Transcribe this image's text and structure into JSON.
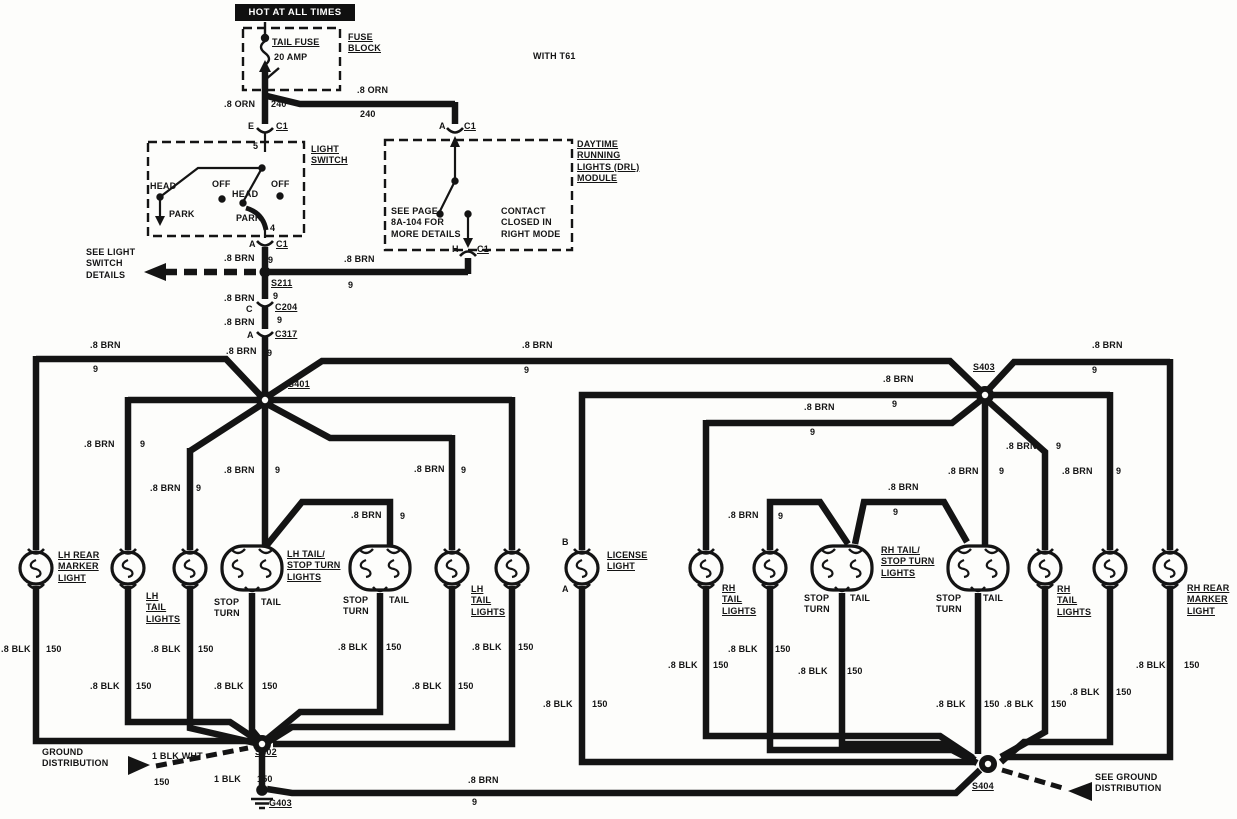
{
  "meta": {
    "title": "Tail lamp / daytime running lights wiring diagram",
    "ink": "#141414",
    "paper": "#fdfdfb"
  },
  "banner": {
    "text": "HOT AT ALL TIMES"
  },
  "labels": [
    {
      "n": "fuse-name-label",
      "t": "TAIL FUSE",
      "x": 272,
      "y": 37,
      "u": 1
    },
    {
      "n": "fuse-rating-label",
      "t": "20 AMP",
      "x": 274,
      "y": 52
    },
    {
      "n": "fuse-block-label",
      "t": "FUSE\nBLOCK",
      "x": 348,
      "y": 32,
      "u": 1
    },
    {
      "n": "option-note",
      "t": "WITH T61",
      "x": 533,
      "y": 51
    },
    {
      "n": "wire-label",
      "t": ".8 ORN",
      "x": 224,
      "y": 99
    },
    {
      "n": "circuit-label",
      "t": "240",
      "x": 271,
      "y": 99
    },
    {
      "n": "wire-label",
      "t": ".8 ORN",
      "x": 357,
      "y": 85
    },
    {
      "n": "circuit-label",
      "t": "240",
      "x": 360,
      "y": 109
    },
    {
      "n": "pin-label",
      "t": "E",
      "x": 248,
      "y": 121
    },
    {
      "n": "connector-label",
      "t": "C1",
      "x": 276,
      "y": 121,
      "u": 1
    },
    {
      "n": "pin-label",
      "t": "A",
      "x": 439,
      "y": 121
    },
    {
      "n": "connector-label",
      "t": "C1",
      "x": 464,
      "y": 121,
      "u": 1
    },
    {
      "n": "light-switch-label",
      "t": "LIGHT\nSWITCH",
      "x": 311,
      "y": 144,
      "u": 1
    },
    {
      "n": "pin-label",
      "t": "5",
      "x": 253,
      "y": 141
    },
    {
      "n": "switch-pos-label",
      "t": "HEAD",
      "x": 150,
      "y": 181
    },
    {
      "n": "switch-pos-label",
      "t": "OFF",
      "x": 212,
      "y": 179
    },
    {
      "n": "switch-pos-label",
      "t": "HEAD",
      "x": 232,
      "y": 189
    },
    {
      "n": "switch-pos-label",
      "t": "OFF",
      "x": 271,
      "y": 179
    },
    {
      "n": "switch-pos-label",
      "t": "PARK",
      "x": 169,
      "y": 209
    },
    {
      "n": "switch-pos-label",
      "t": "PARK",
      "x": 236,
      "y": 213
    },
    {
      "n": "pin-label",
      "t": "4",
      "x": 270,
      "y": 223
    },
    {
      "n": "pin-label",
      "t": "A",
      "x": 249,
      "y": 239
    },
    {
      "n": "connector-label",
      "t": "C1",
      "x": 276,
      "y": 239,
      "u": 1
    },
    {
      "n": "note-see-light-switch",
      "t": "SEE LIGHT\nSWITCH\nDETAILS",
      "x": 86,
      "y": 247
    },
    {
      "n": "wire-label",
      "t": ".8 BRN",
      "x": 224,
      "y": 253
    },
    {
      "n": "circuit-label",
      "t": "9",
      "x": 268,
      "y": 255
    },
    {
      "n": "splice-label",
      "t": "S211",
      "x": 271,
      "y": 278,
      "u": 1
    },
    {
      "n": "circuit-label",
      "t": "9",
      "x": 273,
      "y": 291
    },
    {
      "n": "wire-label",
      "t": ".8 BRN",
      "x": 344,
      "y": 254
    },
    {
      "n": "circuit-label",
      "t": "9",
      "x": 348,
      "y": 280
    },
    {
      "n": "drl-module-label",
      "t": "DAYTIME\nRUNNING\nLIGHTS (DRL)\nMODULE",
      "x": 577,
      "y": 139,
      "u": 1
    },
    {
      "n": "note-see-page",
      "t": "SEE PAGE\n8A-104 FOR\nMORE DETAILS",
      "x": 391,
      "y": 206
    },
    {
      "n": "note-contact",
      "t": "CONTACT\nCLOSED IN\nRIGHT MODE",
      "x": 501,
      "y": 206
    },
    {
      "n": "pin-label",
      "t": "H",
      "x": 452,
      "y": 244
    },
    {
      "n": "connector-label",
      "t": "C1",
      "x": 477,
      "y": 244,
      "u": 1
    },
    {
      "n": "wire-label",
      "t": ".8 BRN",
      "x": 224,
      "y": 293
    },
    {
      "n": "pin-label",
      "t": "C",
      "x": 246,
      "y": 304
    },
    {
      "n": "connector-label",
      "t": "C204",
      "x": 275,
      "y": 302,
      "u": 1
    },
    {
      "n": "circuit-label",
      "t": "9",
      "x": 277,
      "y": 315
    },
    {
      "n": "wire-label",
      "t": ".8 BRN",
      "x": 224,
      "y": 317
    },
    {
      "n": "pin-label",
      "t": "A",
      "x": 247,
      "y": 330
    },
    {
      "n": "connector-label",
      "t": "C317",
      "x": 275,
      "y": 329,
      "u": 1
    },
    {
      "n": "wire-label",
      "t": ".8 BRN",
      "x": 226,
      "y": 346
    },
    {
      "n": "circuit-label",
      "t": "9",
      "x": 267,
      "y": 348
    },
    {
      "n": "wire-label",
      "t": ".8 BRN",
      "x": 90,
      "y": 340
    },
    {
      "n": "circuit-label",
      "t": "9",
      "x": 93,
      "y": 364
    },
    {
      "n": "splice-label",
      "t": "S401",
      "x": 288,
      "y": 379,
      "u": 1
    },
    {
      "n": "wire-label",
      "t": ".8 BRN",
      "x": 84,
      "y": 439
    },
    {
      "n": "circuit-label",
      "t": "9",
      "x": 140,
      "y": 439
    },
    {
      "n": "wire-label",
      "t": ".8 BRN",
      "x": 150,
      "y": 483
    },
    {
      "n": "circuit-label",
      "t": "9",
      "x": 196,
      "y": 483
    },
    {
      "n": "wire-label",
      "t": ".8 BRN",
      "x": 224,
      "y": 465
    },
    {
      "n": "circuit-label",
      "t": "9",
      "x": 275,
      "y": 465
    },
    {
      "n": "wire-label",
      "t": ".8 BRN",
      "x": 414,
      "y": 464
    },
    {
      "n": "circuit-label",
      "t": "9",
      "x": 461,
      "y": 465
    },
    {
      "n": "wire-label",
      "t": ".8 BRN",
      "x": 351,
      "y": 510
    },
    {
      "n": "circuit-label",
      "t": "9",
      "x": 400,
      "y": 511
    },
    {
      "n": "wire-label",
      "t": ".8 BRN",
      "x": 522,
      "y": 340
    },
    {
      "n": "circuit-label",
      "t": "9",
      "x": 524,
      "y": 365
    },
    {
      "n": "wire-label",
      "t": ".8 BRN",
      "x": 883,
      "y": 374
    },
    {
      "n": "circuit-label",
      "t": "9",
      "x": 892,
      "y": 399
    },
    {
      "n": "wire-label",
      "t": ".8 BRN",
      "x": 804,
      "y": 402
    },
    {
      "n": "circuit-label",
      "t": "9",
      "x": 810,
      "y": 427
    },
    {
      "n": "splice-label",
      "t": "S403",
      "x": 973,
      "y": 362,
      "u": 1
    },
    {
      "n": "wire-label",
      "t": ".8 BRN",
      "x": 1092,
      "y": 340
    },
    {
      "n": "circuit-label",
      "t": "9",
      "x": 1092,
      "y": 365
    },
    {
      "n": "wire-label",
      "t": ".8 BRN",
      "x": 948,
      "y": 466
    },
    {
      "n": "circuit-label",
      "t": "9",
      "x": 999,
      "y": 466
    },
    {
      "n": "wire-label",
      "t": ".8 BRN",
      "x": 1006,
      "y": 441
    },
    {
      "n": "circuit-label",
      "t": "9",
      "x": 1056,
      "y": 441
    },
    {
      "n": "wire-label",
      "t": ".8 BRN",
      "x": 1062,
      "y": 466
    },
    {
      "n": "circuit-label",
      "t": "9",
      "x": 1116,
      "y": 466
    },
    {
      "n": "wire-label",
      "t": ".8 BRN",
      "x": 728,
      "y": 510
    },
    {
      "n": "circuit-label",
      "t": "9",
      "x": 778,
      "y": 511
    },
    {
      "n": "wire-label",
      "t": ".8 BRN",
      "x": 888,
      "y": 482
    },
    {
      "n": "circuit-label",
      "t": "9",
      "x": 893,
      "y": 507
    },
    {
      "n": "lamp-name",
      "t": "LH REAR\nMARKER\nLIGHT",
      "x": 58,
      "y": 550,
      "u": 1
    },
    {
      "n": "lamp-name",
      "t": "LH\nTAIL\nLIGHTS",
      "x": 146,
      "y": 591,
      "u": 1
    },
    {
      "n": "pin-label",
      "t": "STOP\nTURN",
      "x": 214,
      "y": 597
    },
    {
      "n": "pin-label",
      "t": "TAIL",
      "x": 261,
      "y": 597
    },
    {
      "n": "lamp-name",
      "t": "LH TAIL/\nSTOP TURN\nLIGHTS",
      "x": 287,
      "y": 549,
      "u": 1
    },
    {
      "n": "pin-label",
      "t": "STOP\nTURN",
      "x": 343,
      "y": 595
    },
    {
      "n": "pin-label",
      "t": "TAIL",
      "x": 389,
      "y": 595
    },
    {
      "n": "lamp-name",
      "t": "LH\nTAIL\nLIGHTS",
      "x": 471,
      "y": 584,
      "u": 1
    },
    {
      "n": "pin-label",
      "t": "B",
      "x": 562,
      "y": 537
    },
    {
      "n": "pin-label",
      "t": "A",
      "x": 562,
      "y": 584
    },
    {
      "n": "lamp-name",
      "t": "LICENSE\nLIGHT",
      "x": 607,
      "y": 550,
      "u": 1
    },
    {
      "n": "lamp-name",
      "t": "RH\nTAIL\nLIGHTS",
      "x": 722,
      "y": 583,
      "u": 1
    },
    {
      "n": "lamp-name",
      "t": "RH TAIL/\nSTOP TURN\nLIGHTS",
      "x": 881,
      "y": 545,
      "u": 1
    },
    {
      "n": "pin-label",
      "t": "STOP\nTURN",
      "x": 804,
      "y": 593
    },
    {
      "n": "pin-label",
      "t": "TAIL",
      "x": 850,
      "y": 593
    },
    {
      "n": "pin-label",
      "t": "STOP\nTURN",
      "x": 936,
      "y": 593
    },
    {
      "n": "pin-label",
      "t": "TAIL",
      "x": 983,
      "y": 593
    },
    {
      "n": "lamp-name",
      "t": "RH\nTAIL\nLIGHTS",
      "x": 1057,
      "y": 584,
      "u": 1
    },
    {
      "n": "lamp-name",
      "t": "RH REAR\nMARKER\nLIGHT",
      "x": 1187,
      "y": 583,
      "u": 1
    },
    {
      "n": "wire-label",
      "t": ".8 BLK",
      "x": 1,
      "y": 644
    },
    {
      "n": "circuit-label",
      "t": "150",
      "x": 46,
      "y": 644
    },
    {
      "n": "wire-label",
      "t": ".8 BLK",
      "x": 90,
      "y": 681
    },
    {
      "n": "circuit-label",
      "t": "150",
      "x": 136,
      "y": 681
    },
    {
      "n": "wire-label",
      "t": ".8 BLK",
      "x": 151,
      "y": 644
    },
    {
      "n": "circuit-label",
      "t": "150",
      "x": 198,
      "y": 644
    },
    {
      "n": "wire-label",
      "t": ".8 BLK",
      "x": 214,
      "y": 681
    },
    {
      "n": "circuit-label",
      "t": "150",
      "x": 262,
      "y": 681
    },
    {
      "n": "wire-label",
      "t": ".8 BLK",
      "x": 338,
      "y": 642
    },
    {
      "n": "circuit-label",
      "t": "150",
      "x": 386,
      "y": 642
    },
    {
      "n": "wire-label",
      "t": ".8 BLK",
      "x": 412,
      "y": 681
    },
    {
      "n": "circuit-label",
      "t": "150",
      "x": 458,
      "y": 681
    },
    {
      "n": "wire-label",
      "t": ".8 BLK",
      "x": 472,
      "y": 642
    },
    {
      "n": "circuit-label",
      "t": "150",
      "x": 518,
      "y": 642
    },
    {
      "n": "wire-label",
      "t": ".8 BLK",
      "x": 543,
      "y": 699
    },
    {
      "n": "circuit-label",
      "t": "150",
      "x": 592,
      "y": 699
    },
    {
      "n": "wire-label",
      "t": ".8 BLK",
      "x": 668,
      "y": 660
    },
    {
      "n": "circuit-label",
      "t": "150",
      "x": 713,
      "y": 660
    },
    {
      "n": "wire-label",
      "t": ".8 BLK",
      "x": 728,
      "y": 644
    },
    {
      "n": "circuit-label",
      "t": "150",
      "x": 775,
      "y": 644
    },
    {
      "n": "wire-label",
      "t": ".8 BLK",
      "x": 798,
      "y": 666
    },
    {
      "n": "circuit-label",
      "t": "150",
      "x": 847,
      "y": 666
    },
    {
      "n": "wire-label",
      "t": ".8 BLK",
      "x": 936,
      "y": 699
    },
    {
      "n": "circuit-label",
      "t": "150",
      "x": 984,
      "y": 699
    },
    {
      "n": "wire-label",
      "t": ".8 BLK",
      "x": 1004,
      "y": 699
    },
    {
      "n": "circuit-label",
      "t": "150",
      "x": 1051,
      "y": 699
    },
    {
      "n": "wire-label",
      "t": ".8 BLK",
      "x": 1070,
      "y": 687
    },
    {
      "n": "circuit-label",
      "t": "150",
      "x": 1116,
      "y": 687
    },
    {
      "n": "wire-label",
      "t": ".8 BLK",
      "x": 1136,
      "y": 660
    },
    {
      "n": "circuit-label",
      "t": "150",
      "x": 1184,
      "y": 660
    },
    {
      "n": "note-ground-distribution",
      "t": "GROUND\nDISTRIBUTION",
      "x": 42,
      "y": 747
    },
    {
      "n": "wire-label",
      "t": "1 BLK WHT",
      "x": 152,
      "y": 751
    },
    {
      "n": "circuit-label",
      "t": "150",
      "x": 154,
      "y": 777
    },
    {
      "n": "splice-label",
      "t": "S402",
      "x": 255,
      "y": 747,
      "u": 1
    },
    {
      "n": "wire-label",
      "t": "1 BLK",
      "x": 214,
      "y": 774
    },
    {
      "n": "circuit-label",
      "t": "150",
      "x": 257,
      "y": 774
    },
    {
      "n": "ground-label",
      "t": "G403",
      "x": 269,
      "y": 798,
      "u": 1
    },
    {
      "n": "wire-label",
      "t": ".8 BRN",
      "x": 468,
      "y": 775
    },
    {
      "n": "circuit-label",
      "t": "9",
      "x": 472,
      "y": 797
    },
    {
      "n": "splice-label",
      "t": "S404",
      "x": 972,
      "y": 781,
      "u": 1
    },
    {
      "n": "note-see-ground-distribution",
      "t": "SEE GROUND\nDISTRIBUTION",
      "x": 1095,
      "y": 772
    }
  ],
  "lamps": [
    {
      "n": "lh-rear-marker-light",
      "type": "single",
      "x": 36
    },
    {
      "n": "lh-tail-light-1",
      "type": "single",
      "x": 128
    },
    {
      "n": "lh-tail-light-2",
      "type": "single",
      "x": 190
    },
    {
      "n": "lh-tail-stop-turn-light-1",
      "type": "dual",
      "x": 252
    },
    {
      "n": "lh-tail-stop-turn-light-2",
      "type": "dual",
      "x": 380
    },
    {
      "n": "lh-tail-light-3",
      "type": "single",
      "x": 452
    },
    {
      "n": "lh-tail-light-4",
      "type": "single",
      "x": 512
    },
    {
      "n": "license-light",
      "type": "single",
      "x": 582
    },
    {
      "n": "rh-tail-light-1",
      "type": "single",
      "x": 706
    },
    {
      "n": "rh-tail-light-2",
      "type": "single",
      "x": 770
    },
    {
      "n": "rh-tail-stop-turn-light-1",
      "type": "dual",
      "x": 842
    },
    {
      "n": "rh-tail-stop-turn-light-2",
      "type": "dual",
      "x": 978
    },
    {
      "n": "rh-tail-light-3",
      "type": "single",
      "x": 1045
    },
    {
      "n": "rh-tail-light-4",
      "type": "single",
      "x": 1110
    },
    {
      "n": "rh-rear-marker-light",
      "type": "single",
      "x": 1170
    }
  ],
  "splices": [
    {
      "n": "splice-s211",
      "x": 265,
      "y": 272,
      "style": "dot"
    },
    {
      "n": "splice-s401",
      "x": 265,
      "y": 400,
      "style": "ring"
    },
    {
      "n": "splice-s403",
      "x": 985,
      "y": 395,
      "style": "ring"
    },
    {
      "n": "splice-s402",
      "x": 262,
      "y": 744,
      "style": "ring"
    },
    {
      "n": "splice-s404",
      "x": 988,
      "y": 764,
      "style": "ring"
    }
  ]
}
